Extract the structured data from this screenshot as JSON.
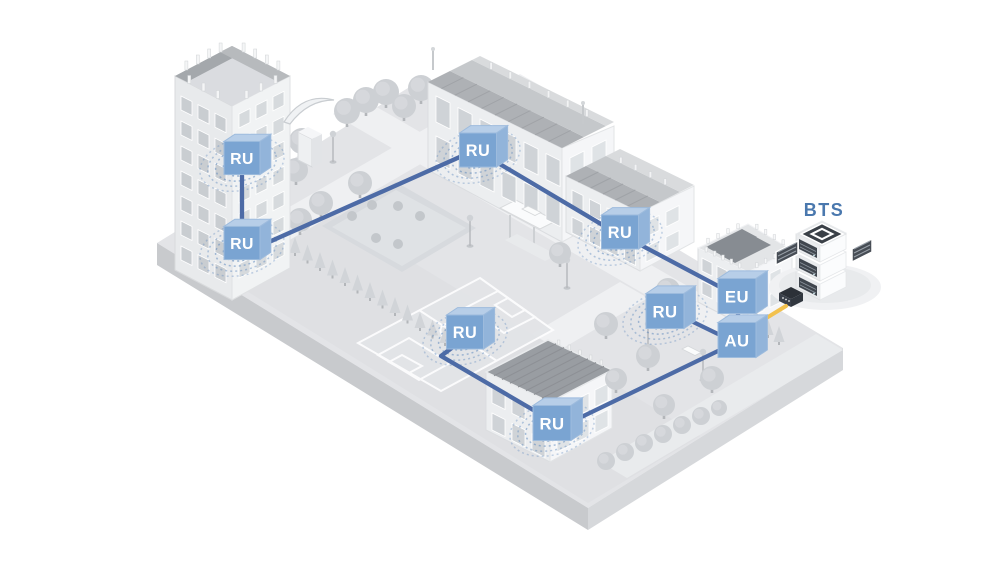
{
  "bts": {
    "label": "BTS"
  },
  "network": {
    "nodes": [
      {
        "id": "ru-tower-upper",
        "label": "RU",
        "type": "RU",
        "x": 242,
        "y": 158,
        "size": 36
      },
      {
        "id": "ru-tower-lower",
        "label": "RU",
        "type": "RU",
        "x": 242,
        "y": 243,
        "size": 36
      },
      {
        "id": "ru-school",
        "label": "RU",
        "type": "RU",
        "x": 478,
        "y": 150,
        "size": 37
      },
      {
        "id": "ru-annex",
        "label": "RU",
        "type": "RU",
        "x": 620,
        "y": 232,
        "size": 37
      },
      {
        "id": "ru-plaza",
        "label": "RU",
        "type": "RU",
        "x": 665,
        "y": 311,
        "size": 38
      },
      {
        "id": "ru-field",
        "label": "RU",
        "type": "RU",
        "x": 465,
        "y": 332,
        "size": 37
      },
      {
        "id": "ru-gym",
        "label": "RU",
        "type": "RU",
        "x": 552,
        "y": 423,
        "size": 38
      },
      {
        "id": "eu",
        "label": "EU",
        "type": "EU",
        "x": 737,
        "y": 296,
        "size": 38
      },
      {
        "id": "au",
        "label": "AU",
        "type": "AU",
        "x": 737,
        "y": 340,
        "size": 38
      }
    ],
    "edges": [
      {
        "from": "ru-tower-upper",
        "to": "ru-tower-lower",
        "color": "blue",
        "points": [
          [
            242,
            176
          ],
          [
            242,
            227
          ]
        ]
      },
      {
        "from": "ru-tower-lower",
        "to": "ru-school",
        "color": "blue",
        "points": [
          [
            260,
            246
          ],
          [
            462,
            156
          ]
        ]
      },
      {
        "from": "ru-school",
        "to": "ru-annex",
        "color": "blue",
        "points": [
          [
            493,
            160
          ],
          [
            606,
            227
          ]
        ]
      },
      {
        "from": "ru-annex",
        "to": "eu",
        "color": "blue",
        "points": [
          [
            637,
            243
          ],
          [
            720,
            287
          ]
        ]
      },
      {
        "from": "eu",
        "to": "au",
        "color": "blue",
        "points": [
          [
            738,
            314
          ],
          [
            738,
            325
          ]
        ]
      },
      {
        "from": "ru-plaza",
        "to": "au",
        "color": "blue",
        "points": [
          [
            683,
            317
          ],
          [
            720,
            335
          ]
        ]
      },
      {
        "from": "au",
        "to": "ru-gym",
        "color": "blue",
        "points": [
          [
            720,
            350
          ],
          [
            569,
            423
          ]
        ]
      },
      {
        "from": "ru-field",
        "to": "ru-gym",
        "color": "blue",
        "points": [
          [
            453,
            347
          ],
          [
            441,
            356
          ],
          [
            535,
            411
          ]
        ]
      },
      {
        "from": "au",
        "to": "bts",
        "color": "yellow",
        "points": [
          [
            755,
            325
          ],
          [
            786,
            306
          ]
        ]
      }
    ]
  },
  "palette": {
    "unit_front": "#7aa4d2",
    "unit_top": "#b7cee8",
    "unit_side": "#92b4da",
    "unit_stroke": "#9dbbdd",
    "line_blue": "#4d6ba6",
    "line_yellow": "#f2c14e",
    "arc_blue": "#5d88bc",
    "bts_label_color": "#4a78ae"
  }
}
